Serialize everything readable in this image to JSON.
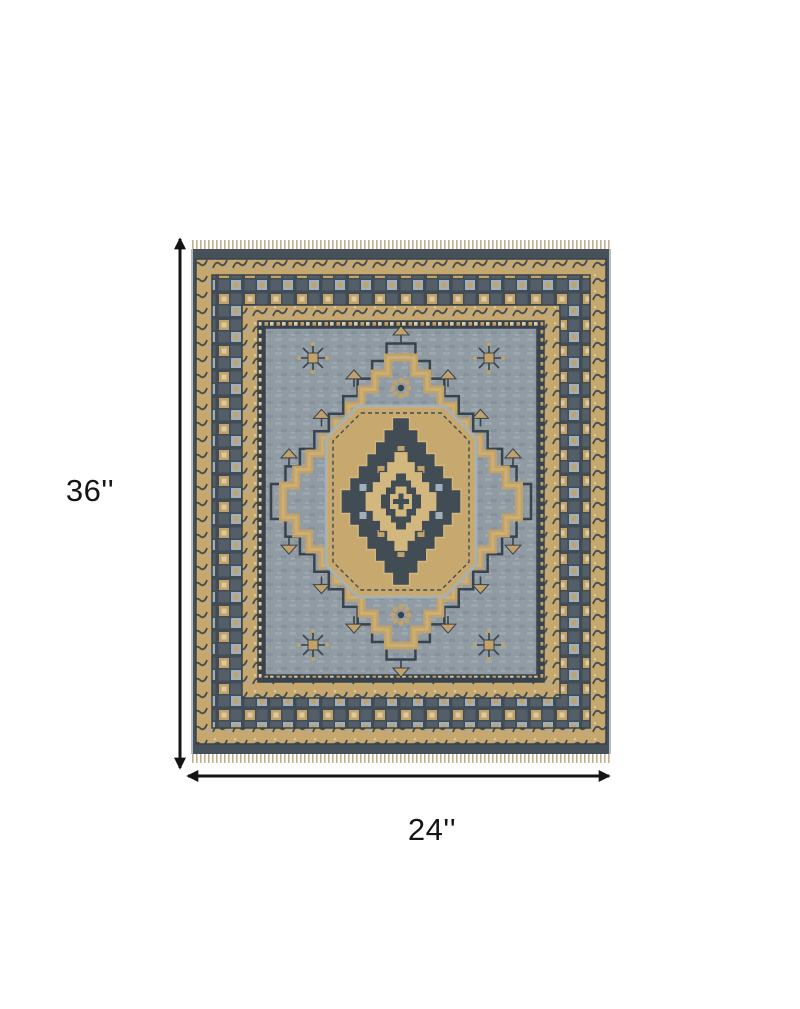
{
  "diagram": {
    "subject": "area rug with geometric tribal medallion pattern",
    "background": "#ffffff"
  },
  "dimensions": {
    "height_label": "36''",
    "width_label": "24''"
  },
  "arrows": {
    "color": "#141414"
  },
  "rug": {
    "colors": {
      "field": "#909ba4",
      "fieldShade": "#86919b",
      "fieldLight": "#9ca7b0",
      "gold": "#c2a268",
      "goldLight": "#d2b77e",
      "cream": "#d9cba4",
      "dark": "#414c55",
      "darker": "#39434c",
      "edge": "#46515a",
      "lightblue": "#9fb0bc",
      "fringe": "#c2b18f",
      "selvage": "#b3bac0"
    }
  }
}
